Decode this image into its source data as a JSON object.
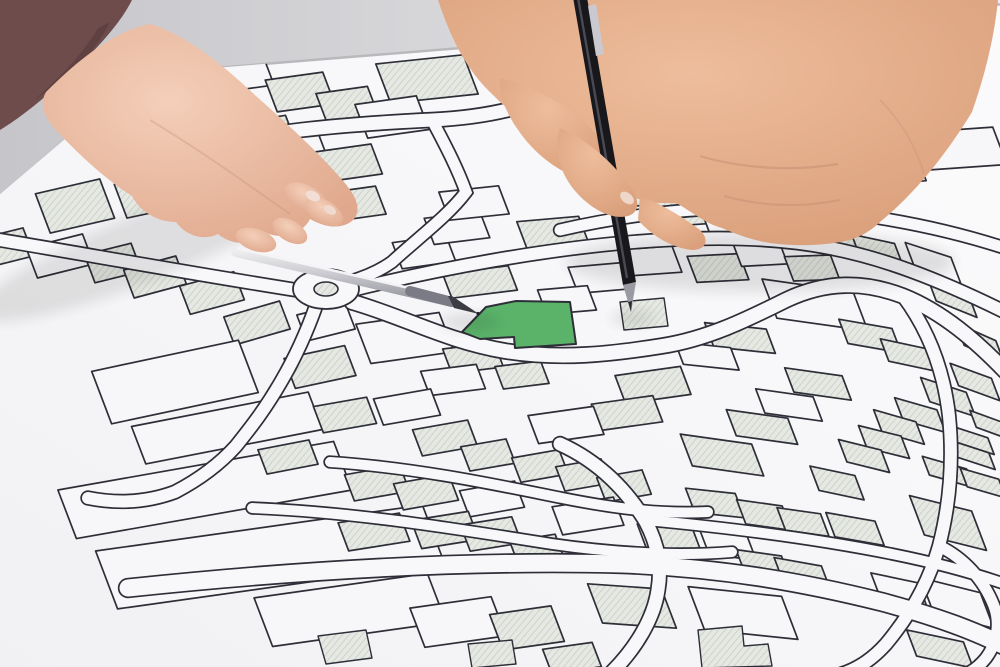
{
  "scene": {
    "description": "Photograph of two hands with pens over a cadastral parcel map; one parcel is highlighted green",
    "highlighted_parcel": "524",
    "objects": {
      "left_hand": "hand holding silver pen pointing at highlighted parcel",
      "right_hand": "hand holding black pen",
      "silver_pen": "silver pen",
      "black_pen": "black pen",
      "sleeve": "dark mauve sleeve",
      "paper": "white cadastral map sheet",
      "table": "light grey table surface"
    },
    "colors": {
      "highlight_green": "#5bb36a",
      "paper": "#f6f6f8",
      "table_left": "#c6c6ca",
      "table_right": "#ebebed",
      "line": "#2e2e38",
      "hatch_fill": "#e6e9e3",
      "hatch_line": "#c2c9bf",
      "label_text": "#4a4a54",
      "skin_left": "#eec3ad",
      "skin_right": "#e2a988",
      "sleeve": "#6e4c4c"
    }
  },
  "map": {
    "label_rotation_deg": 180,
    "defaults": {
      "lean": 0.38,
      "stroke": "#2e2e38"
    },
    "parcels": [
      {
        "l": "1037",
        "x": 163,
        "y": 89,
        "w": 62,
        "h": 40,
        "f": "h",
        "ra": -10
      },
      {
        "l": "1036",
        "x": 233,
        "y": 73,
        "w": 70,
        "h": 36,
        "f": "w",
        "ra": -8
      },
      {
        "l": "1040",
        "x": 427,
        "y": 79,
        "w": 88,
        "h": 42,
        "f": "h",
        "ra": -6
      },
      {
        "l": "1034",
        "x": 300,
        "y": 92,
        "w": 58,
        "h": 34,
        "f": "h",
        "ra": -8
      },
      {
        "l": "1033",
        "x": 347,
        "y": 104,
        "w": 52,
        "h": 30,
        "f": "h",
        "ra": -8
      },
      {
        "l": "1031",
        "x": 392,
        "y": 117,
        "w": 62,
        "h": 36,
        "f": "w",
        "ra": -8
      },
      {
        "l": "940",
        "x": 255,
        "y": 137,
        "w": 74,
        "h": 34,
        "f": "h",
        "ra": -9
      },
      {
        "l": "923",
        "x": 301,
        "y": 151,
        "w": 46,
        "h": 30,
        "f": "w",
        "ra": -8
      },
      {
        "l": "921",
        "x": 348,
        "y": 163,
        "w": 58,
        "h": 32,
        "f": "h",
        "ra": -8
      },
      {
        "l": "811",
        "x": 353,
        "y": 204,
        "w": 56,
        "h": 30,
        "f": "h",
        "ra": -8
      },
      {
        "l": "806",
        "x": 75,
        "y": 206,
        "w": 66,
        "h": 42,
        "f": "h",
        "ra": -13
      },
      {
        "l": "",
        "x": 150,
        "y": 195,
        "w": 60,
        "h": 36,
        "f": "h",
        "ra": -12
      },
      {
        "l": "723",
        "x": 705,
        "y": 124,
        "w": 92,
        "h": 40,
        "f": "w",
        "ra": -5
      },
      {
        "l": "721",
        "x": 808,
        "y": 131,
        "w": 102,
        "h": 42,
        "f": "w",
        "ra": -4
      },
      {
        "l": "",
        "x": 770,
        "y": 176,
        "w": 300,
        "h": 38,
        "f": "h",
        "ra": -5
      },
      {
        "l": "",
        "x": 940,
        "y": 150,
        "w": 120,
        "h": 40,
        "f": "w",
        "ra": -4
      },
      {
        "l": "1261",
        "x": 8,
        "y": 247,
        "w": 42,
        "h": 30,
        "f": "h",
        "ra": -14
      },
      {
        "l": "1260",
        "x": 60,
        "y": 256,
        "w": 58,
        "h": 32,
        "f": "w",
        "ra": -14
      },
      {
        "l": "1257",
        "x": 113,
        "y": 263,
        "w": 48,
        "h": 30,
        "f": "h",
        "ra": -14
      },
      {
        "l": "1258",
        "x": 155,
        "y": 277,
        "w": 54,
        "h": 30,
        "f": "h",
        "ra": -15
      },
      {
        "l": "1255",
        "x": 212,
        "y": 293,
        "w": 56,
        "h": 30,
        "f": "h",
        "ra": -15
      },
      {
        "l": "1253",
        "x": 257,
        "y": 323,
        "w": 58,
        "h": 30,
        "f": "h",
        "ra": -16
      },
      {
        "l": "1251",
        "x": 326,
        "y": 322,
        "w": 50,
        "h": 28,
        "f": "w",
        "ra": -14
      },
      {
        "l": "1209",
        "x": 320,
        "y": 367,
        "w": 62,
        "h": 32,
        "f": "h",
        "ra": -12
      },
      {
        "l": "1153",
        "x": 175,
        "y": 382,
        "w": 150,
        "h": 56,
        "f": "w",
        "ra": -12
      },
      {
        "l": "1154",
        "x": 227,
        "y": 428,
        "w": 180,
        "h": 40,
        "f": "w",
        "ra": -11
      },
      {
        "l": "1120",
        "x": 205,
        "y": 490,
        "w": 280,
        "h": 52,
        "f": "w",
        "ra": -10
      },
      {
        "l": "1387",
        "x": 270,
        "y": 557,
        "w": 330,
        "h": 62,
        "f": "w",
        "ra": -8
      },
      {
        "l": "643",
        "x": 424,
        "y": 252,
        "w": 54,
        "h": 28,
        "f": "w",
        "ra": -8
      },
      {
        "l": "642",
        "x": 457,
        "y": 228,
        "w": 56,
        "h": 28,
        "f": "w",
        "ra": -7
      },
      {
        "l": "641",
        "x": 474,
        "y": 203,
        "w": 60,
        "h": 30,
        "f": "w",
        "ra": -6
      },
      {
        "l": "640",
        "x": 553,
        "y": 233,
        "w": 62,
        "h": 30,
        "f": "h",
        "ra": -5
      },
      {
        "l": "",
        "x": 480,
        "y": 282,
        "w": 66,
        "h": 26,
        "f": "h",
        "ra": -7
      },
      {
        "l": "521",
        "x": 600,
        "y": 278,
        "w": 54,
        "h": 28,
        "f": "w",
        "ra": -5
      },
      {
        "l": "519",
        "x": 650,
        "y": 261,
        "w": 54,
        "h": 28,
        "f": "w",
        "ra": -4
      },
      {
        "l": "523",
        "x": 567,
        "y": 300,
        "w": 50,
        "h": 26,
        "f": "w",
        "ra": -5
      },
      {
        "l": "526",
        "x": 405,
        "y": 338,
        "w": 84,
        "h": 42,
        "f": "w",
        "ra": -8
      },
      {
        "l": "528",
        "x": 473,
        "y": 358,
        "w": 52,
        "h": 26,
        "f": "h",
        "ra": -7
      },
      {
        "l": "530",
        "x": 453,
        "y": 380,
        "w": 56,
        "h": 26,
        "f": "w",
        "ra": -7
      },
      {
        "l": "",
        "x": 522,
        "y": 375,
        "w": 46,
        "h": 24,
        "f": "h",
        "ra": -7
      },
      {
        "l": "518",
        "x": 718,
        "y": 268,
        "w": 52,
        "h": 28,
        "f": "h",
        "ra": -3
      },
      {
        "l": "517",
        "x": 760,
        "y": 253,
        "w": 46,
        "h": 26,
        "f": "w",
        "ra": -3
      },
      {
        "l": "515",
        "x": 812,
        "y": 268,
        "w": 46,
        "h": 26,
        "f": "h",
        "ra": -2
      },
      {
        "l": "619",
        "x": 683,
        "y": 211,
        "w": 48,
        "h": 30,
        "f": "h",
        "ra": -4
      },
      {
        "l": "618",
        "x": 727,
        "y": 220,
        "w": 44,
        "h": 28,
        "f": "w",
        "ra": -2
      },
      {
        "l": "617",
        "x": 778,
        "y": 220,
        "w": 46,
        "h": 28,
        "f": "h",
        "ra": 0
      },
      {
        "l": "615",
        "x": 838,
        "y": 233,
        "w": 46,
        "h": 28,
        "f": "h",
        "ra": 6
      },
      {
        "l": "614",
        "x": 878,
        "y": 252,
        "w": 44,
        "h": 28,
        "f": "h",
        "ra": 12
      },
      {
        "l": "613",
        "x": 933,
        "y": 263,
        "w": 48,
        "h": 28,
        "f": "w",
        "ra": 18
      },
      {
        "l": "612",
        "x": 952,
        "y": 297,
        "w": 44,
        "h": 26,
        "f": "h",
        "ra": 22
      },
      {
        "l": "610",
        "x": 980,
        "y": 343,
        "w": 44,
        "h": 24,
        "f": "h",
        "ra": 24
      },
      {
        "l": "608",
        "x": 975,
        "y": 382,
        "w": 44,
        "h": 24,
        "f": "h",
        "ra": 20
      },
      {
        "l": "607",
        "x": 948,
        "y": 397,
        "w": 48,
        "h": 26,
        "f": "h",
        "ra": 18
      },
      {
        "l": "606",
        "x": 920,
        "y": 415,
        "w": 44,
        "h": 24,
        "f": "h",
        "ra": 16
      },
      {
        "l": "605",
        "x": 899,
        "y": 427,
        "w": 44,
        "h": 24,
        "f": "h",
        "ra": 16
      },
      {
        "l": "604",
        "x": 884,
        "y": 442,
        "w": 44,
        "h": 24,
        "f": "h",
        "ra": 14
      },
      {
        "l": "603",
        "x": 864,
        "y": 456,
        "w": 44,
        "h": 24,
        "f": "h",
        "ra": 14
      },
      {
        "l": "602",
        "x": 837,
        "y": 483,
        "w": 46,
        "h": 26,
        "f": "h",
        "ra": 12
      },
      {
        "l": "1825",
        "x": 990,
        "y": 425,
        "w": 36,
        "h": 18,
        "f": "h",
        "ra": 20
      },
      {
        "l": "1824",
        "x": 972,
        "y": 440,
        "w": 40,
        "h": 18,
        "f": "h",
        "ra": 18
      },
      {
        "l": "1823",
        "x": 973,
        "y": 455,
        "w": 40,
        "h": 18,
        "f": "h",
        "ra": 18
      },
      {
        "l": "1822",
        "x": 948,
        "y": 472,
        "w": 46,
        "h": 20,
        "f": "h",
        "ra": 16
      },
      {
        "l": "1821",
        "x": 983,
        "y": 483,
        "w": 40,
        "h": 20,
        "f": "h",
        "ra": 16
      },
      {
        "l": "408",
        "x": 815,
        "y": 305,
        "w": 92,
        "h": 42,
        "f": "w",
        "ra": 8
      },
      {
        "l": "409",
        "x": 870,
        "y": 336,
        "w": 54,
        "h": 26,
        "f": "h",
        "ra": 10
      },
      {
        "l": "410",
        "x": 908,
        "y": 355,
        "w": 48,
        "h": 24,
        "f": "h",
        "ra": 12
      },
      {
        "l": "406",
        "x": 740,
        "y": 338,
        "w": 62,
        "h": 26,
        "f": "h",
        "ra": 6
      },
      {
        "l": "405",
        "x": 707,
        "y": 356,
        "w": 56,
        "h": 24,
        "f": "w",
        "ra": 6
      },
      {
        "l": "404",
        "x": 653,
        "y": 385,
        "w": 66,
        "h": 30,
        "f": "h",
        "ra": -8
      },
      {
        "l": "403",
        "x": 627,
        "y": 413,
        "w": 62,
        "h": 28,
        "f": "h",
        "ra": -8
      },
      {
        "l": "402",
        "x": 566,
        "y": 425,
        "w": 66,
        "h": 30,
        "f": "w",
        "ra": -8
      },
      {
        "l": "415",
        "x": 818,
        "y": 384,
        "w": 58,
        "h": 26,
        "f": "h",
        "ra": 8
      },
      {
        "l": "417",
        "x": 789,
        "y": 405,
        "w": 58,
        "h": 26,
        "f": "w",
        "ra": 8
      },
      {
        "l": "419",
        "x": 762,
        "y": 427,
        "w": 62,
        "h": 28,
        "f": "h",
        "ra": 8
      },
      {
        "l": "420",
        "x": 722,
        "y": 455,
        "w": 72,
        "h": 34,
        "f": "h",
        "ra": 8
      },
      {
        "l": "1197",
        "x": 345,
        "y": 415,
        "w": 54,
        "h": 28,
        "f": "h",
        "ra": -10
      },
      {
        "l": "1189",
        "x": 407,
        "y": 407,
        "w": 58,
        "h": 28,
        "f": "w",
        "ra": -10
      },
      {
        "l": "1185",
        "x": 445,
        "y": 438,
        "w": 56,
        "h": 28,
        "f": "h",
        "ra": -10
      },
      {
        "l": "1162",
        "x": 288,
        "y": 457,
        "w": 52,
        "h": 26,
        "f": "h",
        "ra": -11
      },
      {
        "l": "1162",
        "x": 488,
        "y": 455,
        "w": 46,
        "h": 26,
        "f": "h",
        "ra": -10
      },
      {
        "l": "1179",
        "x": 540,
        "y": 466,
        "w": 48,
        "h": 26,
        "f": "h",
        "ra": -10
      },
      {
        "l": "1178",
        "x": 583,
        "y": 475,
        "w": 46,
        "h": 26,
        "f": "h",
        "ra": -10
      },
      {
        "l": "1175",
        "x": 624,
        "y": 486,
        "w": 46,
        "h": 26,
        "f": "h",
        "ra": -10
      },
      {
        "l": "1165",
        "x": 377,
        "y": 483,
        "w": 56,
        "h": 28,
        "f": "h",
        "ra": -10
      },
      {
        "l": "1168",
        "x": 426,
        "y": 492,
        "w": 56,
        "h": 28,
        "f": "h",
        "ra": -10
      },
      {
        "l": "1170",
        "x": 492,
        "y": 499,
        "w": 56,
        "h": 28,
        "f": "w",
        "ra": -10
      },
      {
        "l": "1172",
        "x": 588,
        "y": 516,
        "w": 62,
        "h": 30,
        "f": "w",
        "ra": -9
      },
      {
        "l": "1119",
        "x": 374,
        "y": 532,
        "w": 62,
        "h": 30,
        "f": "h",
        "ra": -9
      },
      {
        "l": "1116",
        "x": 445,
        "y": 530,
        "w": 58,
        "h": 30,
        "f": "h",
        "ra": -9
      },
      {
        "l": "1113",
        "x": 491,
        "y": 534,
        "w": 52,
        "h": 28,
        "f": "h",
        "ra": -9
      },
      {
        "l": "1112",
        "x": 537,
        "y": 550,
        "w": 46,
        "h": 26,
        "f": "h",
        "ra": -9
      },
      {
        "l": "1320",
        "x": 350,
        "y": 610,
        "w": 175,
        "h": 52,
        "f": "w",
        "ra": -8
      },
      {
        "l": "1322",
        "x": 458,
        "y": 622,
        "w": 82,
        "h": 42,
        "f": "w",
        "ra": -8
      },
      {
        "l": "1326",
        "x": 527,
        "y": 628,
        "w": 62,
        "h": 38,
        "f": "h",
        "ra": -8
      },
      {
        "l": "1321",
        "x": 572,
        "y": 658,
        "w": 50,
        "h": 26,
        "f": "h",
        "ra": -8
      },
      {
        "l": "422",
        "x": 715,
        "y": 503,
        "w": 50,
        "h": 26,
        "f": "h",
        "ra": 6
      },
      {
        "l": "423",
        "x": 764,
        "y": 515,
        "w": 46,
        "h": 26,
        "f": "h",
        "ra": 8
      },
      {
        "l": "424",
        "x": 803,
        "y": 522,
        "w": 44,
        "h": 24,
        "f": "h",
        "ra": 8
      },
      {
        "l": "425",
        "x": 855,
        "y": 529,
        "w": 50,
        "h": 26,
        "f": "h",
        "ra": 10
      },
      {
        "l": "427",
        "x": 948,
        "y": 523,
        "w": 64,
        "h": 42,
        "f": "h",
        "ra": 14
      },
      {
        "l": "322",
        "x": 670,
        "y": 540,
        "w": 56,
        "h": 28,
        "f": "h",
        "ra": 6
      },
      {
        "l": "323",
        "x": 728,
        "y": 545,
        "w": 48,
        "h": 26,
        "f": "w",
        "ra": 8
      },
      {
        "l": "324",
        "x": 763,
        "y": 564,
        "w": 46,
        "h": 24,
        "f": "h",
        "ra": 8
      },
      {
        "l": "325",
        "x": 802,
        "y": 573,
        "w": 48,
        "h": 24,
        "f": "h",
        "ra": 10
      },
      {
        "l": "312",
        "x": 632,
        "y": 606,
        "w": 74,
        "h": 42,
        "f": "h",
        "ra": 4
      },
      {
        "l": "301",
        "x": 743,
        "y": 613,
        "w": 94,
        "h": 46,
        "f": "w",
        "ra": 6
      },
      {
        "l": "347",
        "x": 899,
        "y": 590,
        "w": 48,
        "h": 26,
        "f": "w",
        "ra": 12
      },
      {
        "l": "1621",
        "x": 957,
        "y": 603,
        "w": 62,
        "h": 38,
        "f": "w",
        "ra": 14
      },
      {
        "l": "1620",
        "x": 940,
        "y": 649,
        "w": 58,
        "h": 28,
        "f": "h",
        "ra": 12
      },
      {
        "l": "524",
        "x": 518,
        "y": 324,
        "f": "g",
        "ra": -6,
        "poly": "462,332 486,307 516,301 570,302 576,344 515,348 514,337 480,339"
      }
    ],
    "roads": [
      {
        "d": "M 148,158 C 260,130 350,124 432,120 C 492,117 532,106 574,86",
        "w": 13
      },
      {
        "d": "M 432,120 C 448,150 458,170 466,192 C 448,216 418,238 392,262 C 378,272 362,278 348,282",
        "w": 11
      },
      {
        "d": "M 0,240 C 95,256 195,274 296,290",
        "w": 12
      },
      {
        "d": "M 352,290 C 450,266 545,250 622,243 C 700,236 770,236 830,248 C 882,258 936,278 1005,312",
        "w": 12
      },
      {
        "d": "M 560,230 C 655,208 755,202 852,214 C 912,222 962,234 1005,248",
        "w": 11
      },
      {
        "d": "M 352,302 C 402,316 446,341 505,351 C 560,360 612,354 662,346 C 707,339 746,320 786,300 C 826,281 864,281 903,296 C 943,312 977,342 1005,371",
        "w": 14
      },
      {
        "d": "M 316,306 C 306,334 296,356 282,380 C 266,408 252,426 236,446 C 218,466 198,480 175,492 C 148,502 118,504 88,498",
        "w": 12
      },
      {
        "d": "M 330,462 C 420,468 502,486 562,498 C 622,510 664,514 708,512",
        "w": 10
      },
      {
        "d": "M 252,508 C 352,512 452,528 552,544 C 622,554 682,556 732,552",
        "w": 10
      },
      {
        "d": "M 128,588 C 300,570 472,560 622,564 C 722,568 802,582 882,602 C 942,618 976,632 1005,646",
        "w": 17
      },
      {
        "d": "M 560,444 C 600,462 628,492 646,522 C 658,545 662,566 658,590 C 654,618 636,648 612,672",
        "w": 13
      },
      {
        "d": "M 646,520 C 732,528 812,538 892,554 C 942,564 976,574 1005,584",
        "w": 10
      },
      {
        "d": "M 903,296 C 930,332 944,372 949,416 C 953,456 951,500 939,546 C 929,582 911,614 886,644 C 870,662 852,672 834,676",
        "w": 12
      },
      {
        "d": "M 939,546 C 964,558 984,580 994,606 C 1000,622 998,642 986,658 C 970,678 948,682 928,678",
        "w": 11
      }
    ],
    "roundabout": {
      "cx": 326,
      "cy": 289,
      "rx": 31,
      "ry": 18,
      "inner_rx": 12,
      "inner_ry": 7
    },
    "footprints": [
      {
        "pts": "698,630 742,626 744,646 768,644 772,666 702,668"
      },
      {
        "pts": "318,636 366,630 372,658 326,664"
      },
      {
        "pts": "468,644 512,640 516,664 472,668"
      },
      {
        "pts": "620,302 664,298 668,326 624,330"
      }
    ]
  }
}
